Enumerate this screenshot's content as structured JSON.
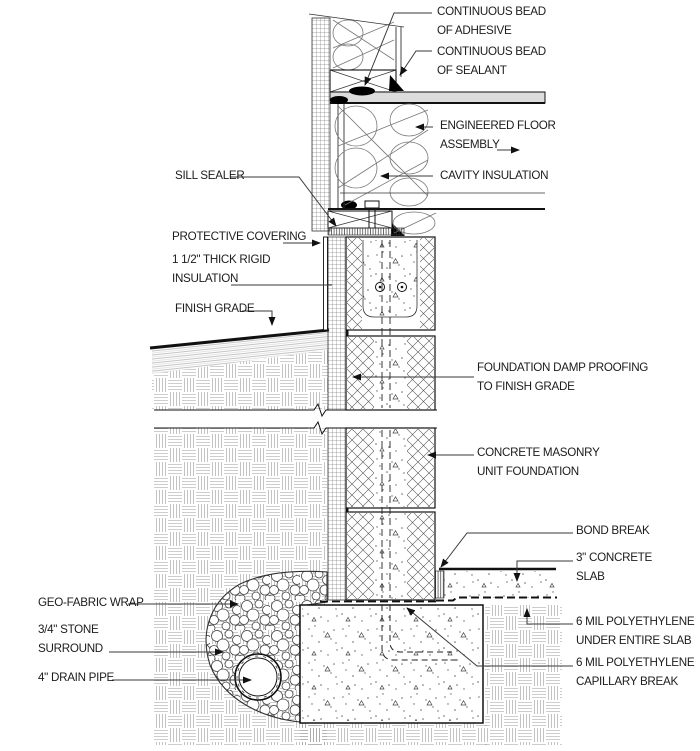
{
  "drawing": {
    "type": "architectural-foundation-section-detail",
    "ink_color": "#1c1c1c",
    "leader_color": "#3a3a3a",
    "hatch_gray": "#9b9b9b"
  },
  "labels": {
    "continuous_bead_adhesive": "CONTINUOUS BEAD\nOF ADHESIVE",
    "continuous_bead_sealant": "CONTINUOUS BEAD\nOF SEALANT",
    "engineered_floor_assembly": "ENGINEERED FLOOR\nASSEMBLY",
    "cavity_insulation": "CAVITY INSULATION",
    "sill_sealer": "SILL SEALER",
    "protective_covering": "PROTECTIVE COVERING",
    "rigid_insulation": "1 1/2\" THICK RIGID\nINSULATION",
    "finish_grade": "FINISH GRADE",
    "foundation_damp_proofing": "FOUNDATION DAMP PROOFING\nTO FINISH GRADE",
    "cmu_foundation": "CONCRETE MASONRY\nUNIT FOUNDATION",
    "bond_break": "BOND BREAK",
    "concrete_slab": "3\" CONCRETE\nSLAB",
    "poly_under_slab": "6 MIL POLYETHYLENE\nUNDER ENTIRE SLAB",
    "poly_capillary_break": "6 MIL POLYETHYLENE\nCAPILLARY BREAK",
    "geo_fabric_wrap": "GEO-FABRIC WRAP",
    "stone_surround": "3/4\" STONE\nSURROUND",
    "drain_pipe": "4\" DRAIN PIPE"
  }
}
